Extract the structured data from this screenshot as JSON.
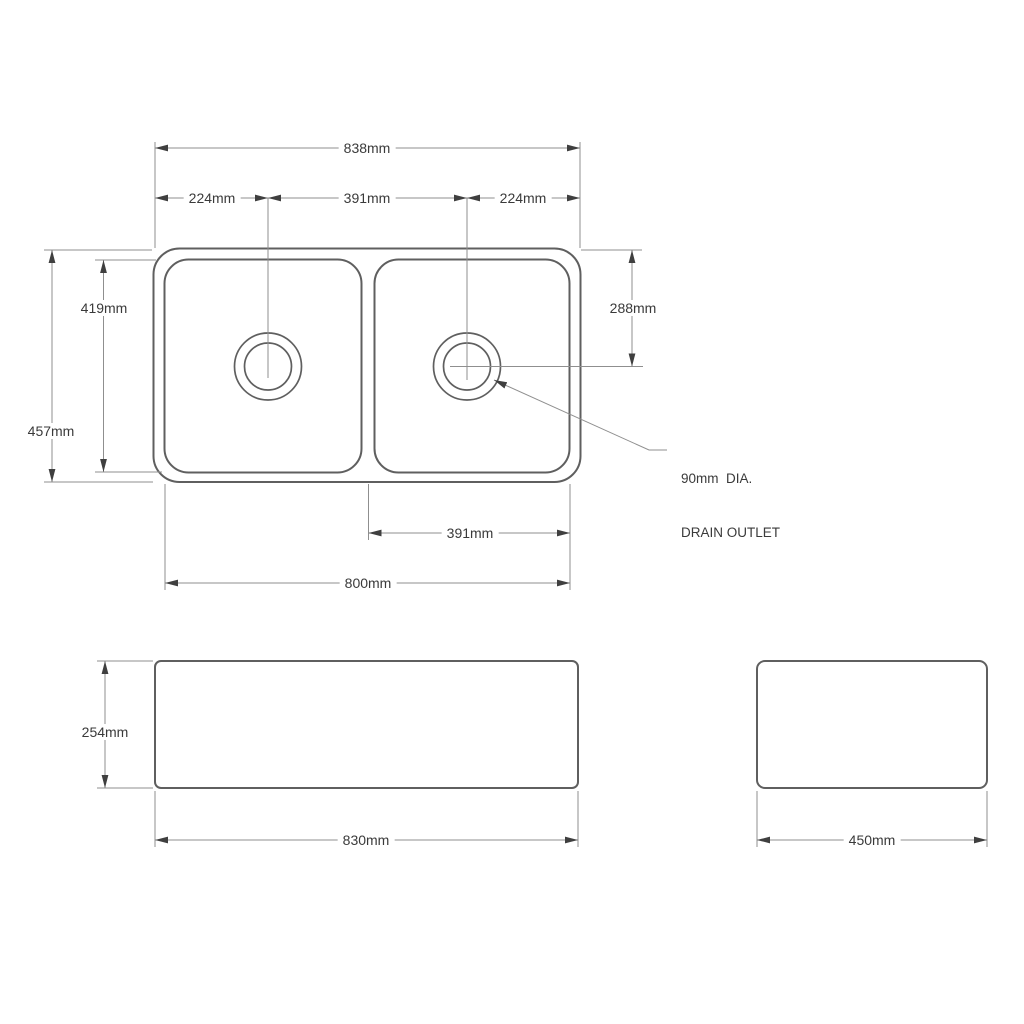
{
  "colors": {
    "background": "#ffffff",
    "outline": "#5f5f5f",
    "line": "#8f8f8f",
    "arrow": "#3f3f3f",
    "text": "#3a3a3a"
  },
  "top_view": {
    "dim_overall_width": "838mm",
    "dim_left_drain_offset": "224mm",
    "dim_drain_spacing": "391mm",
    "dim_right_drain_offset": "224mm",
    "dim_bowl_front_to_back": "419mm",
    "dim_overall_front_to_back": "457mm",
    "dim_drain_position": "288mm",
    "dim_bowl_width": "391mm",
    "dim_base_width": "800mm",
    "drain_note_line1": "90mm  DIA.",
    "drain_note_line2": "DRAIN OUTLET"
  },
  "front_view": {
    "dim_height": "254mm",
    "dim_width": "830mm"
  },
  "side_view": {
    "dim_width": "450mm"
  }
}
